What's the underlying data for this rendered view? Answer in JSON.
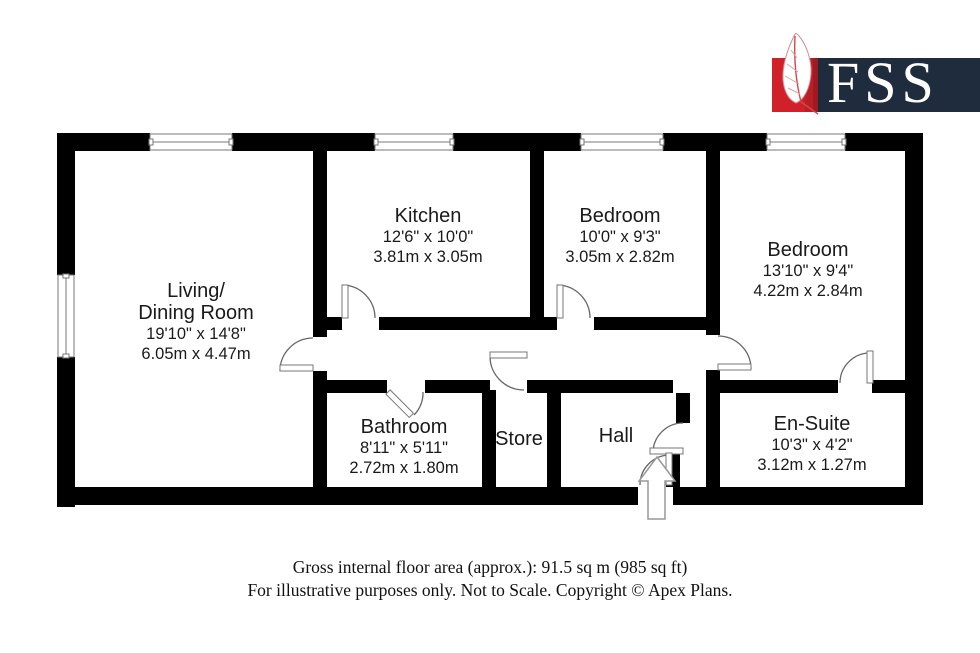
{
  "logo": {
    "brand": "FSS"
  },
  "rooms": {
    "living": {
      "name1": "Living/",
      "name2": "Dining Room",
      "imperial": "19'10\" x 14'8\"",
      "metric": "6.05m x 4.47m"
    },
    "kitchen": {
      "name1": "Kitchen",
      "imperial": "12'6\" x 10'0\"",
      "metric": "3.81m x 3.05m"
    },
    "bedroom1": {
      "name1": "Bedroom",
      "imperial": "10'0\" x 9'3\"",
      "metric": "3.05m x 2.82m"
    },
    "bedroom2": {
      "name1": "Bedroom",
      "imperial": "13'10\" x 9'4\"",
      "metric": "4.22m x 2.84m"
    },
    "bathroom": {
      "name1": "Bathroom",
      "imperial": "8'11\" x 5'11\"",
      "metric": "2.72m x 1.80m"
    },
    "store": {
      "name1": "Store"
    },
    "hall": {
      "name1": "Hall"
    },
    "ensuite": {
      "name1": "En-Suite",
      "imperial": "10'3\" x 4'2\"",
      "metric": "3.12m x 1.27m"
    }
  },
  "footer": {
    "line1": "Gross internal floor area (approx.): 91.5 sq m (985 sq ft)",
    "line2": "For illustrative purposes only. Not to Scale. Copyright © Apex Plans."
  },
  "colors": {
    "wall": "#000000",
    "logo_red": "#d02128",
    "logo_navy": "#1f2c3e"
  }
}
